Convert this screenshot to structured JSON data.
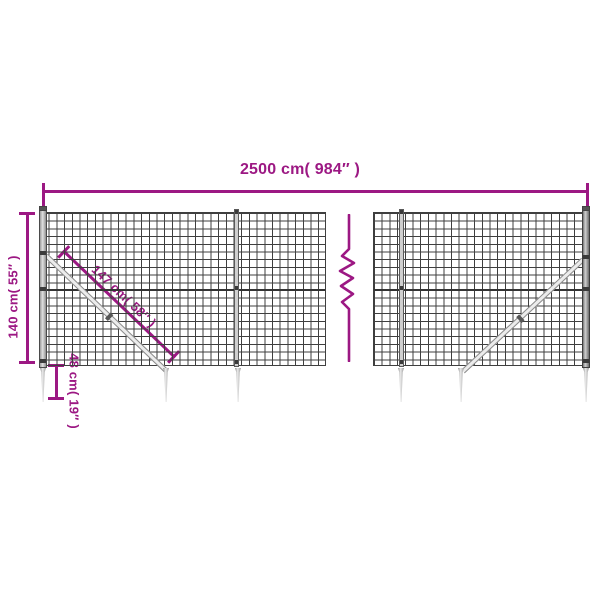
{
  "diagram": {
    "type": "product-dimension-diagram",
    "subject": "wire mesh fence with ground anchor spikes",
    "dimensions": {
      "total_width": {
        "label": "2500 cm( 984″ )"
      },
      "height": {
        "label": "140 cm( 55″ )"
      },
      "brace_length": {
        "label": "147 cm( 58″ )"
      },
      "anchor_depth": {
        "label": "48 cm( 19″ )"
      }
    },
    "colors": {
      "dimension_accent": "#9c1883",
      "mesh_line": "#3f3f3f",
      "metal_light": "#ececec",
      "metal_dark": "#6a6a6a",
      "background": "#ffffff"
    },
    "icons": {
      "break_symbol": "vertical-zigzag-break"
    }
  }
}
